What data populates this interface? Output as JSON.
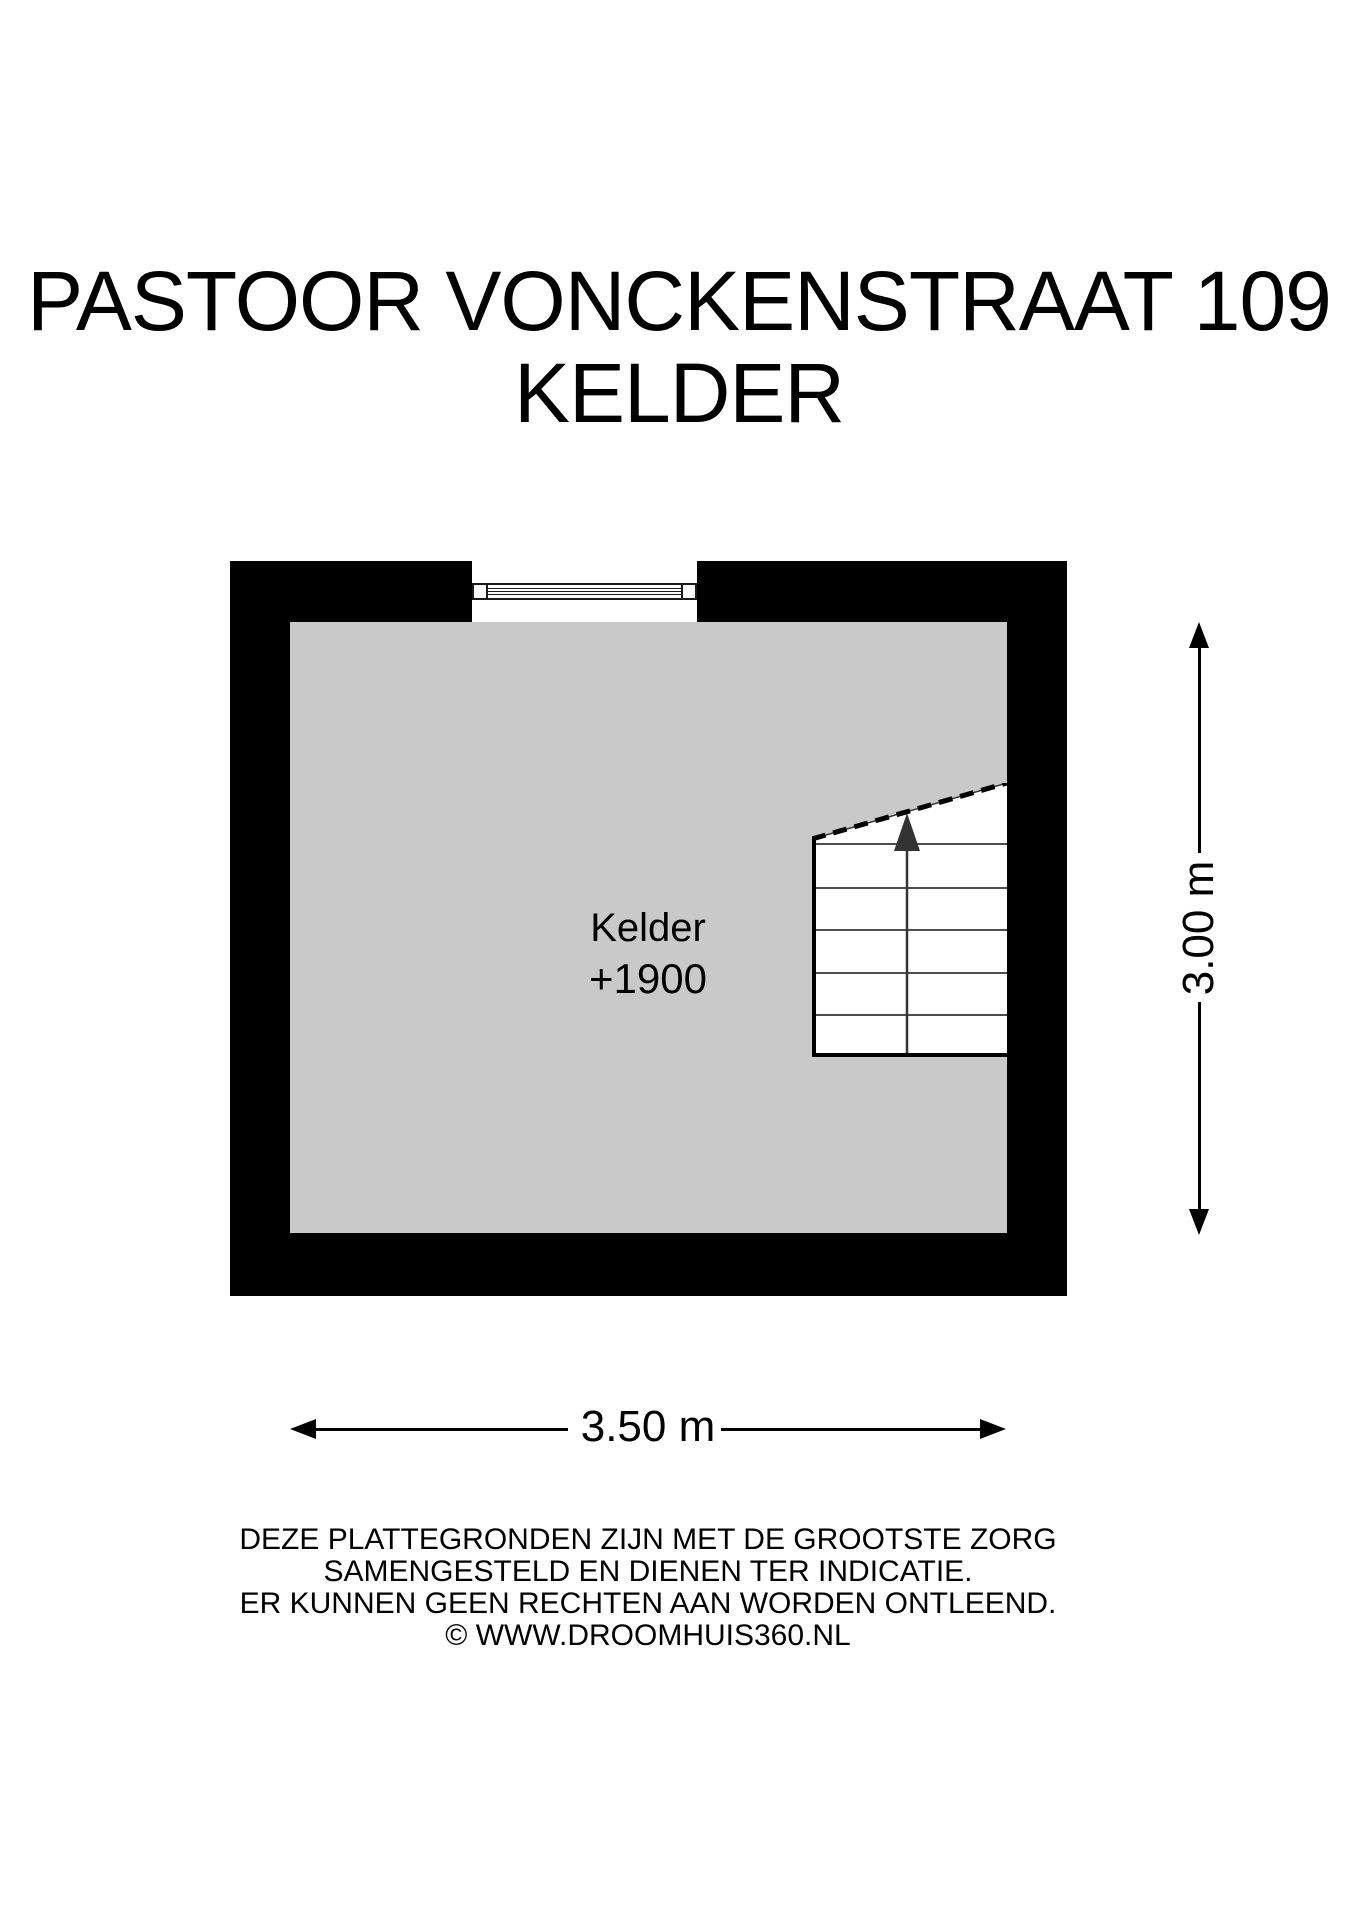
{
  "title": {
    "line1": "PASTOOR VONCKENSTRAAT 109",
    "line2": "KELDER"
  },
  "room": {
    "name": "Kelder",
    "level": "+1900"
  },
  "dimensions": {
    "width_label": "3.50 m",
    "height_label": "3.00 m"
  },
  "disclaimer": {
    "line1": "DEZE PLATTEGRONDEN ZIJN MET DE GROOTSTE ZORG",
    "line2": "SAMENGESTELD EN DIENEN TER INDICATIE.",
    "line3": "ER KUNNEN GEEN RECHTEN AAN WORDEN ONTLEEND.",
    "line4": "© WWW.DROOMHUIS360.NL"
  },
  "colors": {
    "wall": "#000000",
    "floor": "#c9c9c9",
    "background": "#ffffff",
    "text": "#000000",
    "stair_tread": "#4d4d4d",
    "walk_arrow": "#333333"
  }
}
